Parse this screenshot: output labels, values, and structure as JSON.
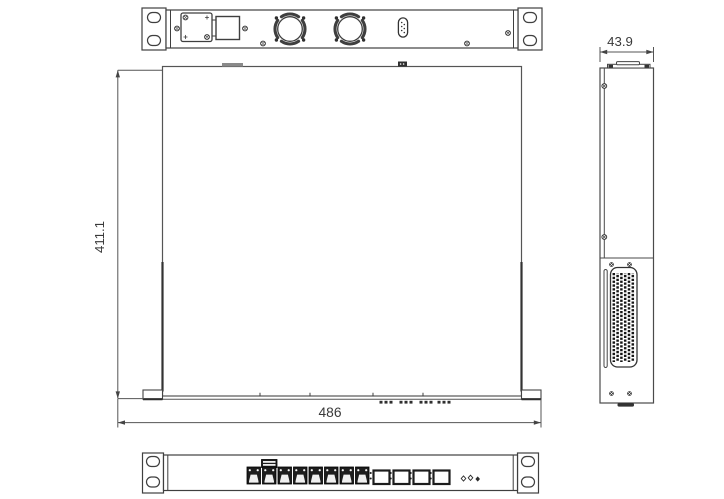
{
  "drawing": {
    "type": "mechanical-dimension-drawing",
    "subject": "1U rackmount network appliance",
    "dimensions": {
      "depth_mm": "411.1",
      "width_mm": "486",
      "height_mm": "43.9"
    },
    "components": {
      "rear_fans": 2,
      "serial_ports": 1,
      "front_rj45_ports": 8,
      "front_sfp_cages": 4,
      "mounting_holes_per_ear": 2
    }
  }
}
